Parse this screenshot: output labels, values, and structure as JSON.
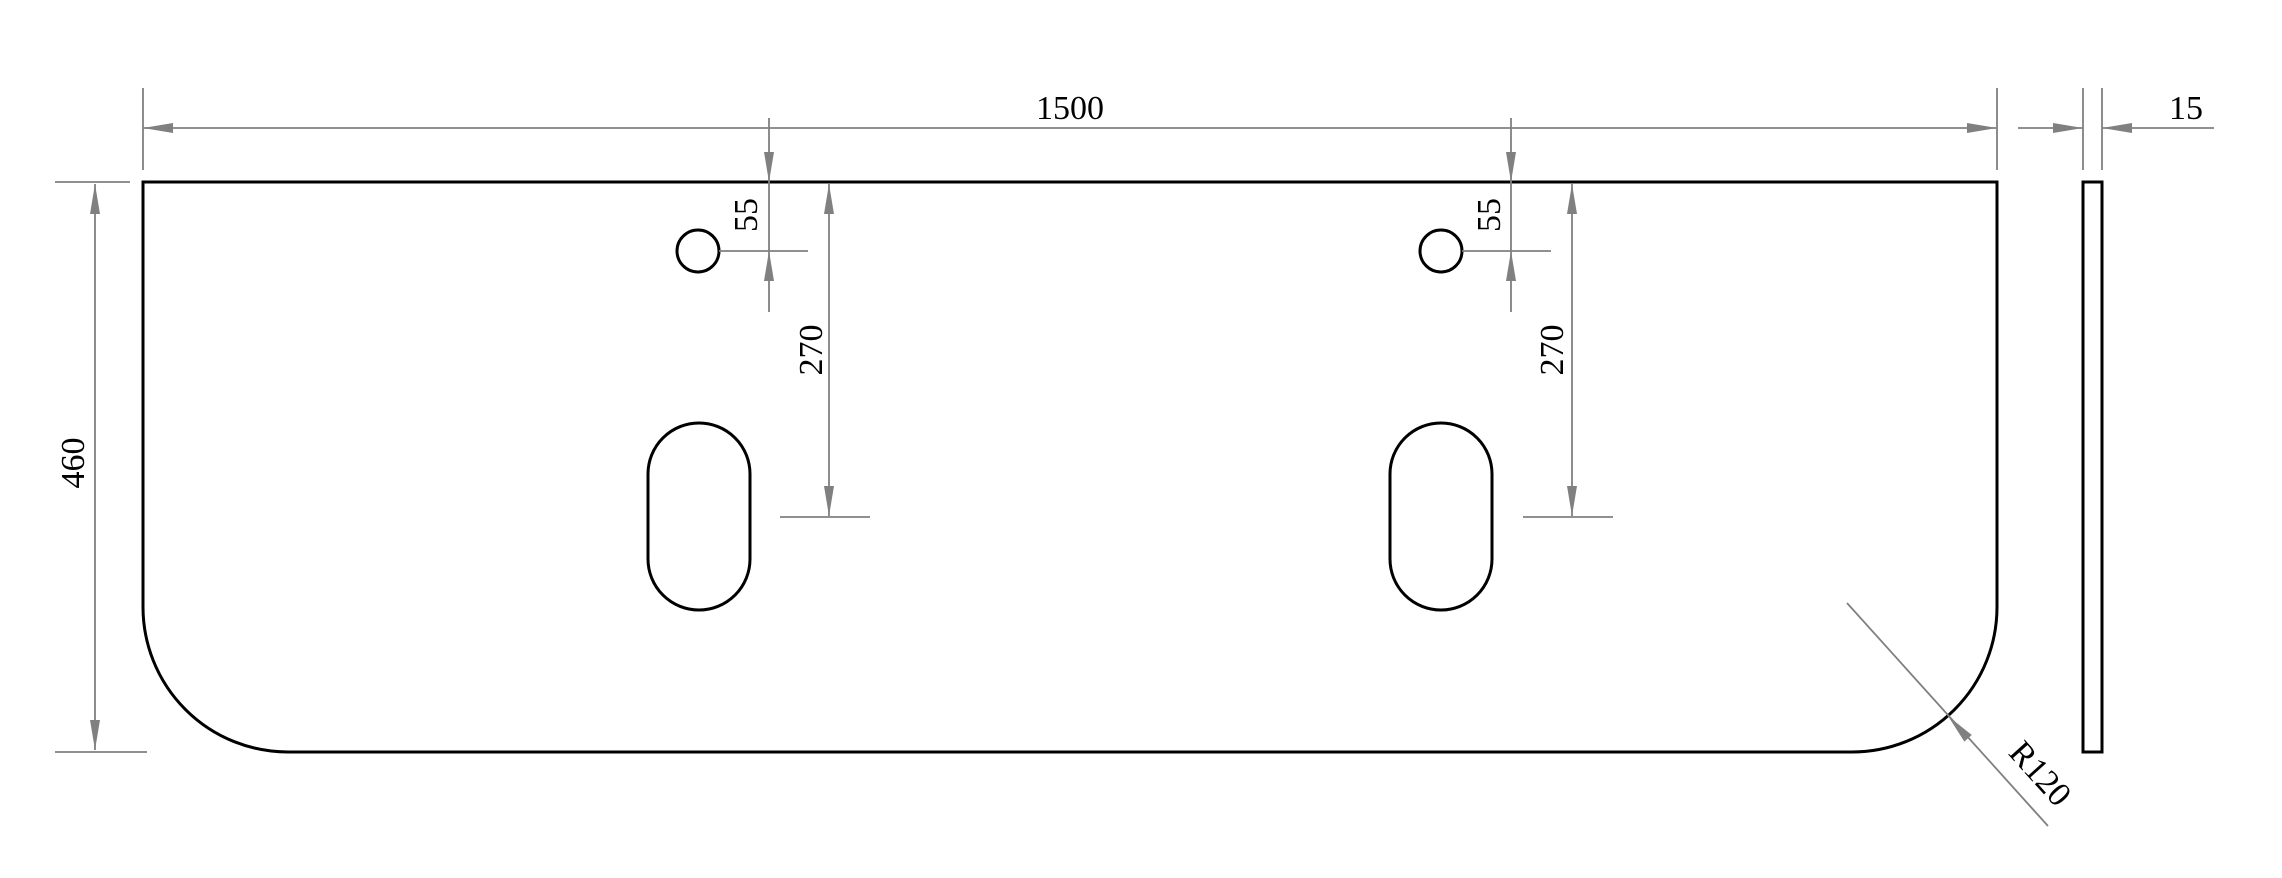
{
  "drawing": {
    "colors": {
      "background": "#ffffff",
      "part_outline": "#000000",
      "dimension_lines": "#808080",
      "dimension_text": "#000000"
    },
    "top_view": {
      "width_label": "1500",
      "depth_label": "460",
      "corner_radius_label": "R120",
      "left_hole_group": {
        "faucet_hole_offset_label": "55",
        "slot_center_offset_label": "270"
      },
      "right_hole_group": {
        "faucet_hole_offset_label": "55",
        "slot_center_offset_label": "270"
      }
    },
    "side_view": {
      "thickness_label": "15"
    }
  }
}
